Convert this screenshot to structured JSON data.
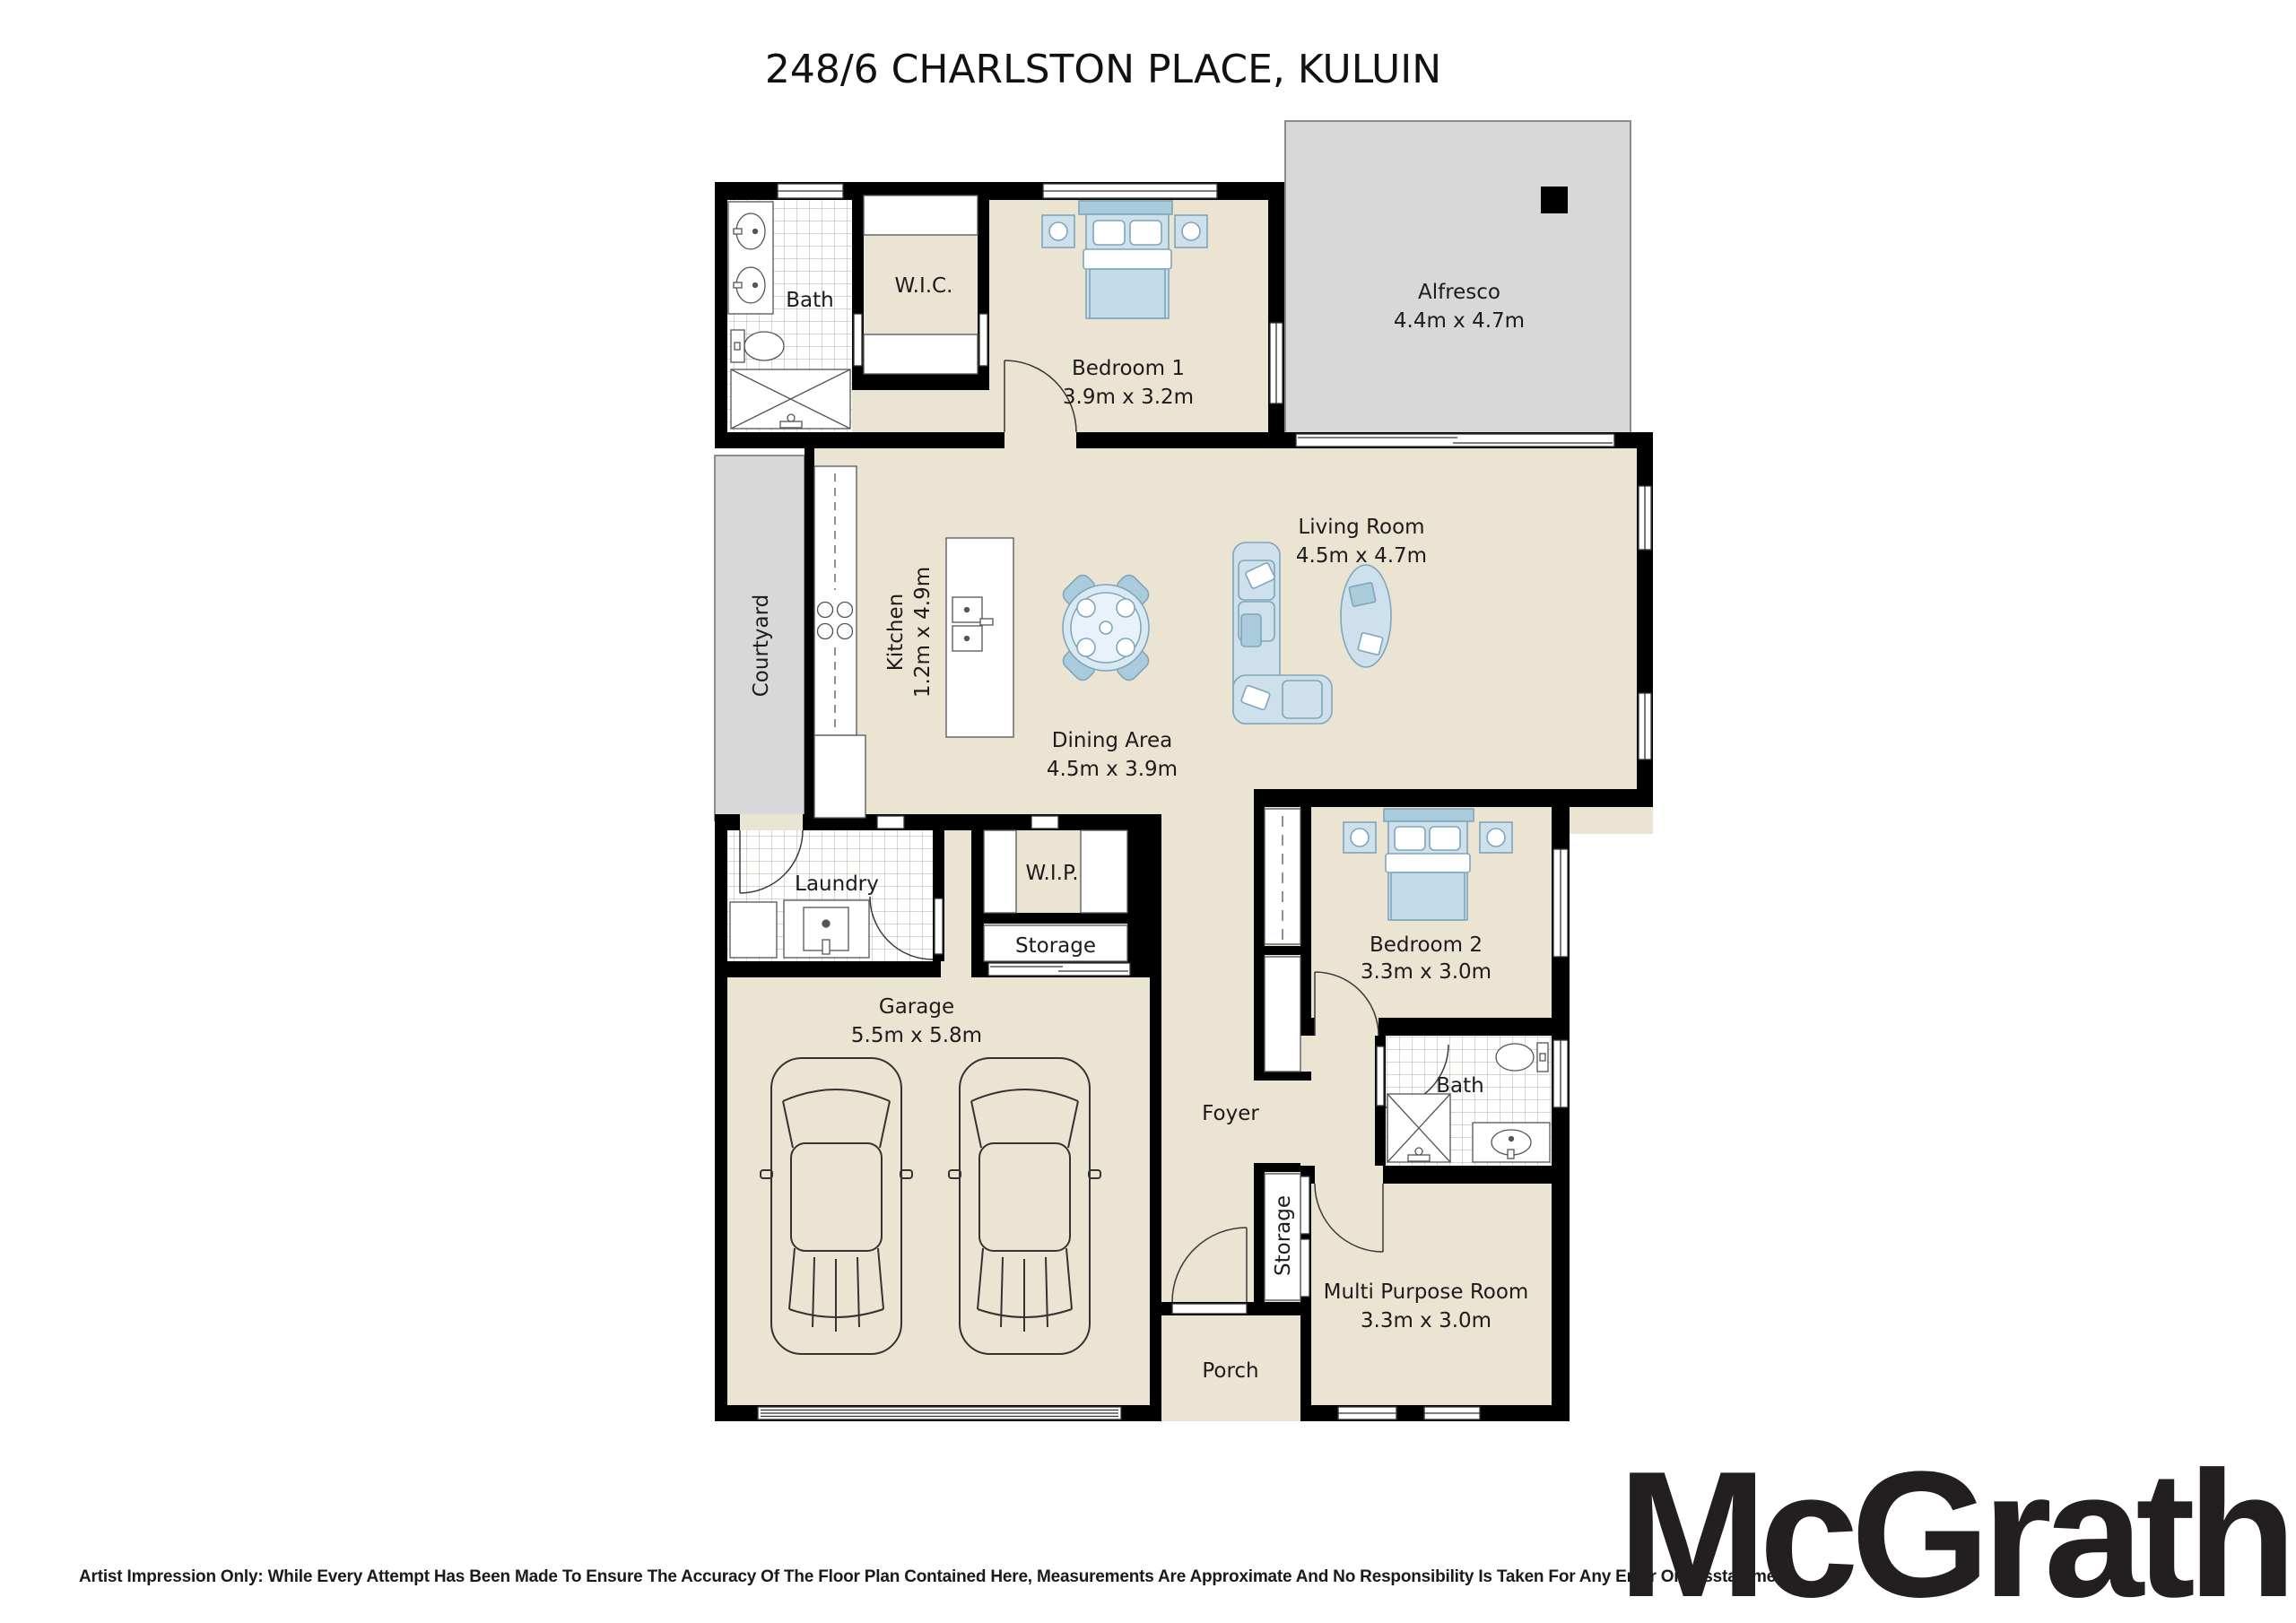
{
  "title": "248/6 CHARLSTON PLACE, KULUIN",
  "brand": {
    "logo_text": "McGrath"
  },
  "disclaimer": "Artist Impression Only: While Every Attempt Has Been Made To Ensure The Accuracy Of The Floor Plan Contained Here, Measurements Are Approximate And No Responsibility Is Taken For Any Error Or Misstatement.",
  "colors": {
    "wall": "#000000",
    "floor": "#ECE4D2",
    "outdoor": "#D8D8D8",
    "furniture_fill": "#CDE0EB",
    "furniture_accent": "#A9CBDC",
    "furniture_stroke": "#7FA6BA"
  },
  "rooms": {
    "bath1": {
      "label": "Bath"
    },
    "wic": {
      "label": "W.I.C."
    },
    "bedroom1": {
      "label": "Bedroom 1",
      "dims": "3.9m x 3.2m"
    },
    "alfresco": {
      "label": "Alfresco",
      "dims": "4.4m x 4.7m"
    },
    "courtyard": {
      "label": "Courtyard"
    },
    "kitchen": {
      "label": "Kitchen",
      "dims": "1.2m x 4.9m"
    },
    "dining": {
      "label": "Dining Area",
      "dims": "4.5m x 3.9m"
    },
    "living": {
      "label": "Living Room",
      "dims": "4.5m x 4.7m"
    },
    "laundry": {
      "label": "Laundry"
    },
    "wip": {
      "label": "W.I.P."
    },
    "storage1": {
      "label": "Storage"
    },
    "garage": {
      "label": "Garage",
      "dims": "5.5m x 5.8m"
    },
    "foyer": {
      "label": "Foyer"
    },
    "bedroom2": {
      "label": "Bedroom 2",
      "dims": "3.3m x 3.0m"
    },
    "bath2": {
      "label": "Bath"
    },
    "storage2": {
      "label": "Storage"
    },
    "mpr": {
      "label": "Multi Purpose Room",
      "dims": "3.3m x 3.0m"
    },
    "porch": {
      "label": "Porch"
    }
  }
}
